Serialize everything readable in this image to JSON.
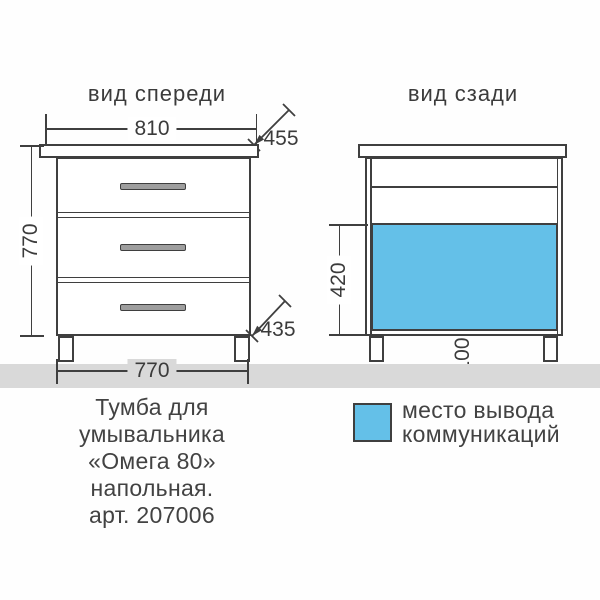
{
  "page": {
    "background": "#fefefe",
    "line_color": "#3f3f3f",
    "accent_blue": "#64c0e8",
    "floor_color": "#d9d9d9",
    "handle_color": "#9e9e9e"
  },
  "front_view": {
    "title": "вид спереди",
    "dim_top_width": "810",
    "dim_top_depth": "455",
    "dim_height": "770",
    "dim_bottom_depth": "435",
    "dim_bottom_width": "770",
    "drawer_count": 3
  },
  "back_view": {
    "title": "вид сзади",
    "dim_cutout_height": "420",
    "dim_cutout_bottom_offset": "100"
  },
  "caption": {
    "lines": [
      "Тумба для",
      "умывальника",
      "«Омега 80»",
      "напольная.",
      "арт. 207006"
    ]
  },
  "legend": {
    "line1": "место вывода",
    "line2": "коммуникаций"
  }
}
